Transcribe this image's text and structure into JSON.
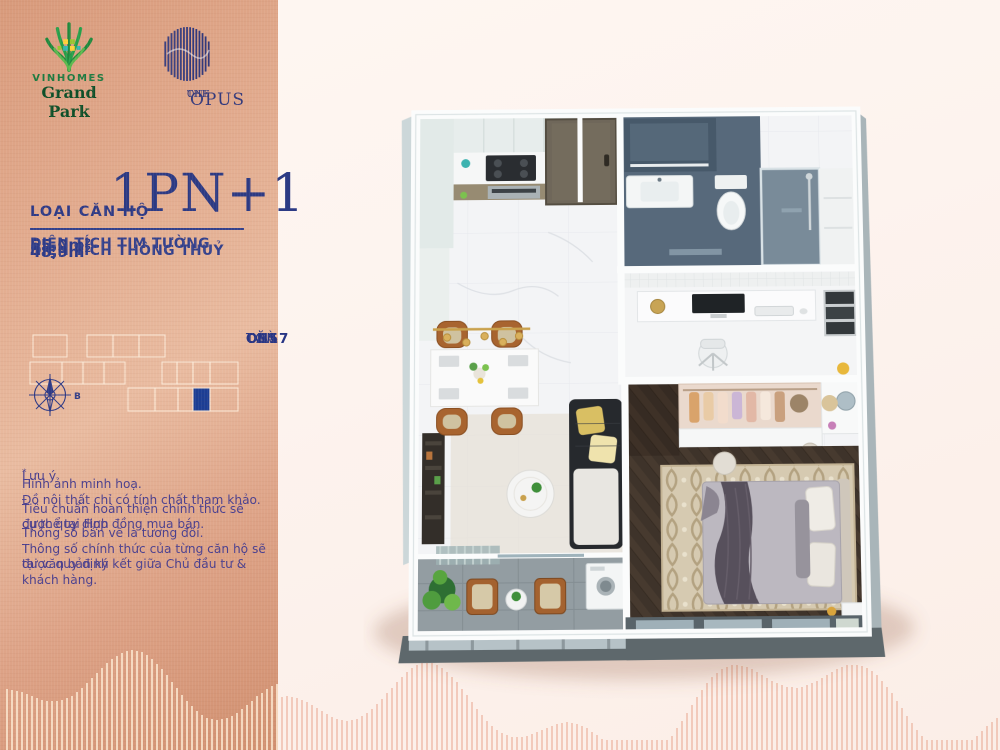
{
  "branding": {
    "vinhomes": {
      "line1": "VINHOMES",
      "line2": "Grand Park"
    },
    "opus": {
      "pre": "THE",
      "name": "OPUS",
      "post": "ONE"
    }
  },
  "unit": {
    "type_label": "LOẠI CĂN HỘ",
    "type_value": "1PN+1",
    "areas": [
      {
        "label": "DIỆN TÍCH TIM TƯỜNG",
        "value": "55,0m²"
      },
      {
        "label": "DIỆN TÍCH THÔNG THUỶ",
        "value": "48,9m²"
      }
    ]
  },
  "location": {
    "building_label": "TOÀ",
    "building_value": "OS5",
    "unit_label": "CĂN",
    "unit_value": "CH17",
    "compass_label": "B",
    "grid": {
      "outline_color": "rgba(252,234,216,0.9)",
      "highlight_color": "#1c3e94",
      "rows": [
        {
          "y": 2,
          "h": 22,
          "cells": [
            {
              "x": 5,
              "w": 34
            },
            {
              "x": 59,
              "w": 26
            },
            {
              "x": 85,
              "w": 26
            },
            {
              "x": 111,
              "w": 26
            }
          ]
        },
        {
          "y": 29,
          "h": 22,
          "cells": [
            {
              "x": 2,
              "w": 32
            },
            {
              "x": 34,
              "w": 21
            },
            {
              "x": 55,
              "w": 21
            },
            {
              "x": 76,
              "w": 21
            },
            {
              "x": 134,
              "w": 15
            },
            {
              "x": 149,
              "w": 16
            },
            {
              "x": 165,
              "w": 17
            },
            {
              "x": 182,
              "w": 28
            }
          ]
        },
        {
          "y": 55,
          "h": 23,
          "cells": [
            {
              "x": 100,
              "w": 27
            },
            {
              "x": 127,
              "w": 23
            },
            {
              "x": 150,
              "w": 15
            },
            {
              "x": 165,
              "w": 17,
              "filled": true
            },
            {
              "x": 182,
              "w": 28
            }
          ]
        }
      ]
    }
  },
  "notes": {
    "mark": "*",
    "title": "Lưu ý",
    "paragraphs": [
      [
        "Hình ảnh minh hoạ.",
        "Đồ nội thất chỉ có tính chất tham khảo."
      ],
      [
        "Tiêu chuẩn hoàn thiện chính thức sẽ được quy định",
        "cụ thể tại Hợp đồng mua bán."
      ],
      [
        "Thông số bản vẽ là tương đối.",
        "Thông số chính thức của từng căn hộ sẽ được quy định",
        "tại văn bản ký kết giữa Chủ đầu tư & khách hàng."
      ]
    ]
  },
  "colors": {
    "panel_rose": "#e0a88c",
    "navy_text": "#2e3a86",
    "grid_highlight": "#1c3e94",
    "background_cream": "#fdf3ee",
    "stripe_on_panel": "rgba(250,228,205,0.85)",
    "stripe_on_cream": "rgba(233,172,150,0.55)",
    "vinhomes_green": "#1d7a40",
    "opus_navy": "#32397c"
  }
}
